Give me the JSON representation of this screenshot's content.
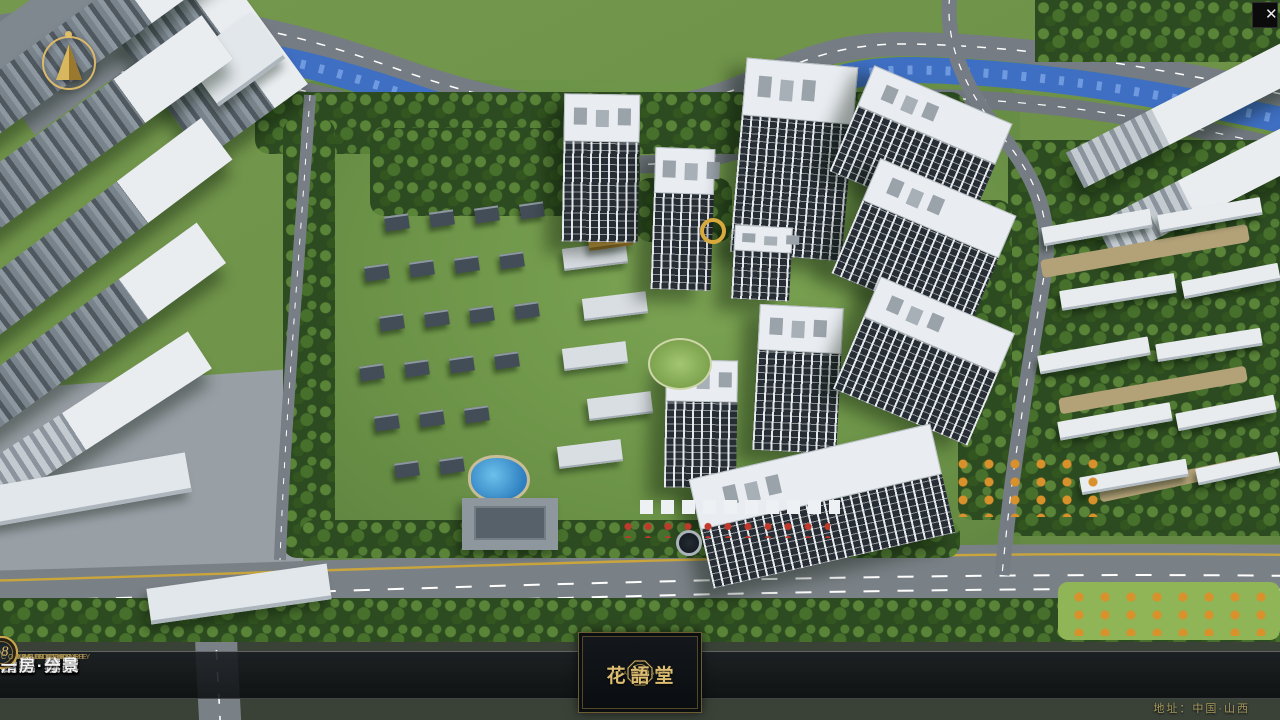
{
  "app": {
    "close_glyph": "✕"
  },
  "nav": {
    "items": [
      {
        "num": "o1",
        "label": "品牌·介绍",
        "sub": "BRAND SUPPORT"
      },
      {
        "num": "o2",
        "label": "区位·价值",
        "sub": "LOCATION VALUE"
      },
      {
        "num": "o3",
        "label": "项目·概况",
        "sub": "PROJECT SURVEY"
      },
      {
        "num": "o4",
        "label": "建筑·鉴赏",
        "sub": "APPRECIATION"
      },
      {
        "num": "o5",
        "label": "园林·景观",
        "sub": "GARDEN STREET"
      },
      {
        "num": "o6",
        "label": "精装·体验",
        "sub": "EXPERIENCE"
      },
      {
        "num": "o7",
        "label": "户型·分布",
        "sub": "SHOW ROOM"
      },
      {
        "num": "o8",
        "label": "一房·一景",
        "sub": "COMMUNITY"
      }
    ]
  },
  "logo": {
    "title": "花語堂",
    "subtitle": "HUA YU TANG"
  },
  "footer": {
    "address": "地址：中国·山西"
  },
  "colors": {
    "gold": "#c9a558",
    "river": "#3f6fc2",
    "road": "#757c83"
  }
}
